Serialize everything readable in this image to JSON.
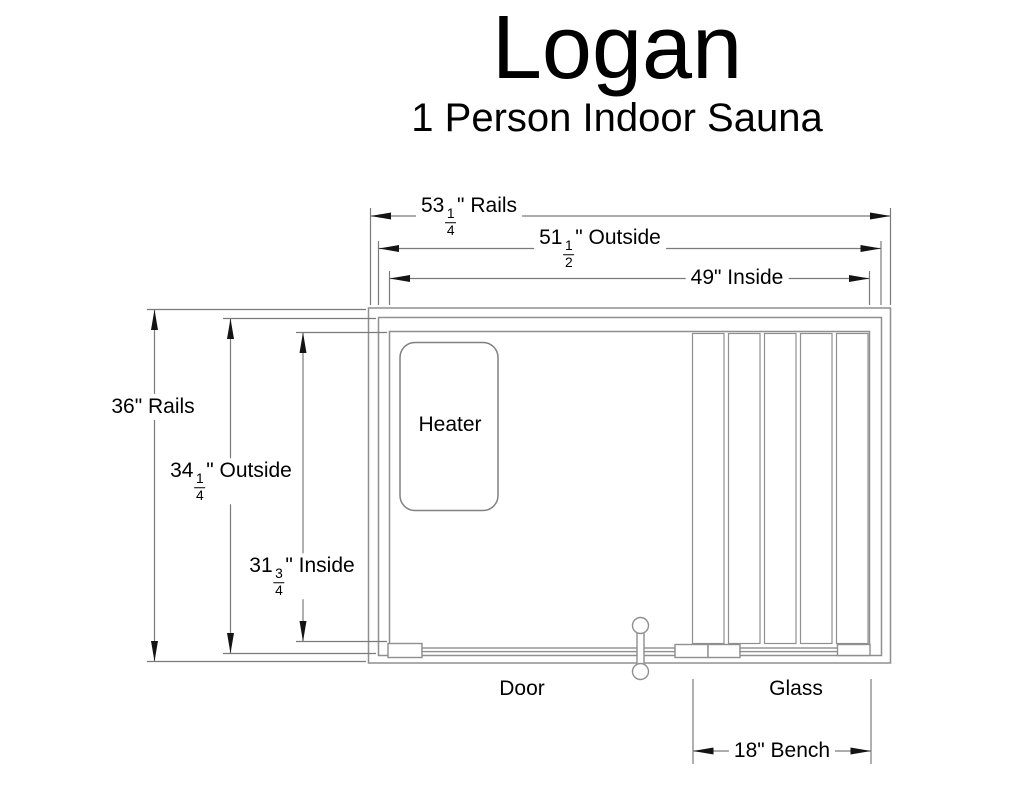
{
  "header": {
    "title": "Logan",
    "subtitle": "1 Person Indoor Sauna"
  },
  "dims": {
    "rails_width": {
      "whole": "53",
      "num": "1",
      "den": "4",
      "suffix": "\" Rails"
    },
    "outside_width": {
      "whole": "51",
      "num": "1",
      "den": "2",
      "suffix": "\" Outside"
    },
    "inside_width": {
      "text": "49\" Inside"
    },
    "rails_height": {
      "text": "36\" Rails"
    },
    "outside_height": {
      "whole": "34",
      "num": "1",
      "den": "4",
      "suffix": "\" Outside"
    },
    "inside_height": {
      "whole": "31",
      "num": "3",
      "den": "4",
      "suffix": "\" Inside"
    },
    "bench": {
      "text": "18\" Bench"
    }
  },
  "labels": {
    "heater": "Heater",
    "door": "Door",
    "glass": "Glass"
  },
  "plan": {
    "bench_slat_count": 5
  },
  "colors": {
    "background": "#ffffff",
    "wall_line": "#8f8f8f",
    "dimension_line": "#7a7a7a",
    "arrow": "#141414",
    "text": "#000000"
  }
}
